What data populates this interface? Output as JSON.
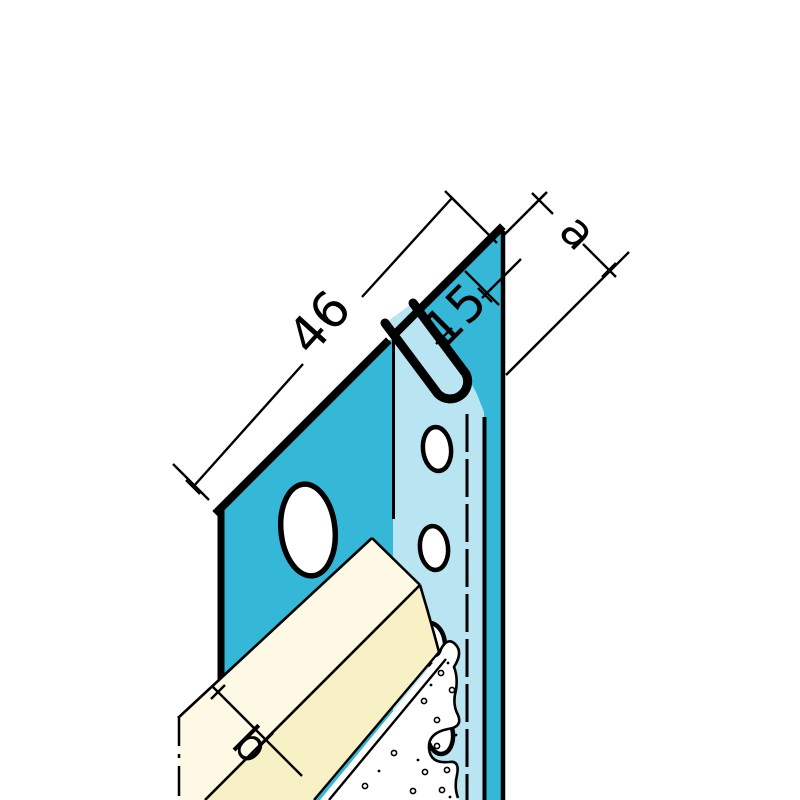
{
  "diagram": {
    "kind": "technical-drawing",
    "subject": "expansion-joint-profile-cross-section",
    "labels": {
      "overall_width": "46",
      "slot_width": "15",
      "depth": "a",
      "board_thickness": "b"
    },
    "colors": {
      "profile_front": "#35b8d8",
      "profile_side": "#b9e4f2",
      "board_edge": "#fdf9e4",
      "board_face": "#f8f1c6",
      "outline": "#000000",
      "background": "#ffffff"
    }
  }
}
